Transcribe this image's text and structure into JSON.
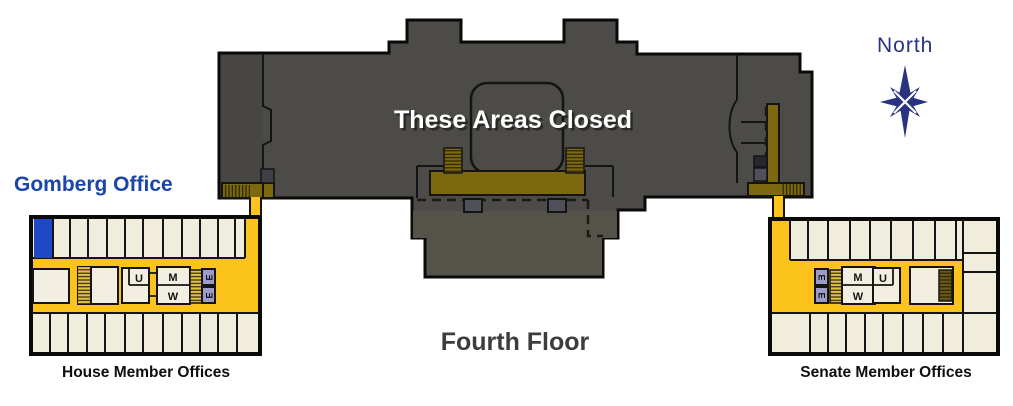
{
  "labels": {
    "floor_title": "Fourth Floor",
    "closed_area": "These Areas Closed",
    "compass": "North",
    "gomberg_office": "Gomberg Office"
  },
  "house_wing": {
    "label": "House Member Offices",
    "rooms": {
      "unisex": "U",
      "men": "M",
      "women": "W",
      "elevator": "E"
    }
  },
  "senate_wing": {
    "label": "Senate Member Offices",
    "rooms": {
      "unisex": "U",
      "men": "M",
      "women": "W",
      "elevator": "E"
    }
  },
  "colors": {
    "background": "#FFFFFF",
    "building_gray": "#4C4B47",
    "annex_gray": "#555349",
    "corridor_yellow": "#FCC31D",
    "office_cream": "#F0EDDD",
    "balcony_gold": "#7C690F",
    "stair_gold": "#E2BF49",
    "elevator_lavender": "#9C9CC8",
    "gomberg_highlight_blue": "#2047C5",
    "gomberg_label_blue": "#1B45A8",
    "compass_navy": "#2A3380",
    "title_gray": "#3D3D3D"
  }
}
